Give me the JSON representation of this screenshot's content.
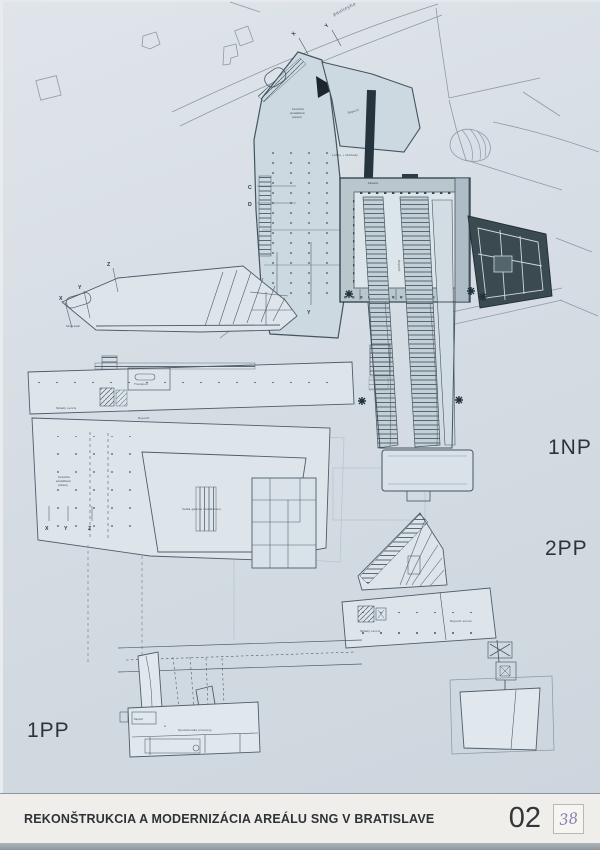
{
  "board": {
    "title": "REKONŠTRUKCIA A MODERNIZÁCIA AREÁLU SNG V BRATISLAVE",
    "sheet_number": "02",
    "handwritten_note": "38"
  },
  "floor_labels": {
    "np1": "1NP",
    "pp2": "2PP",
    "pp1": "1PP"
  },
  "context": {
    "street_name": "paulinyho"
  },
  "markers": {
    "street_x": "X",
    "street_y": "Y",
    "section_c": "C",
    "section_d": "D",
    "bottom_x": "X",
    "bottom_y": "Y",
    "left_top": [
      "X",
      "Y",
      "Z"
    ],
    "left_bottom": [
      "X",
      "Y",
      "Z"
    ],
    "room_a": "A"
  },
  "room_labels": {
    "depozit_top": "Depozit",
    "depozit_mid": "Depozit",
    "lobby": "Lobby + obchody",
    "komercne_l1": "Komerčné",
    "komercne_l2": "prevádzkové",
    "komercne_l3": "priestory",
    "kaviaren": "Kaviareň",
    "expozicie": "Expozície",
    "servis_areal": "Servis areál",
    "transport": "Transport",
    "sklady_servis_left": "Sklady servis",
    "depozit_left": "Depozit",
    "velka_galeria": "Veľká galéria / auditórium",
    "sklady_servis_right": "Sklady servis",
    "depozit_servis_right": "Depozit servis",
    "spolocenske": "Spoločenské priestory",
    "depozit_1pp": "Depozit"
  },
  "colors": {
    "paper": "#d5dce3",
    "titlebar": "#efeeea",
    "plan_line": "#53636f",
    "wall_dark": "#2e3d47",
    "dark_block": "#3a4a50",
    "context_line": "#8e9aa6",
    "handwriting": "#8a7cb4"
  }
}
